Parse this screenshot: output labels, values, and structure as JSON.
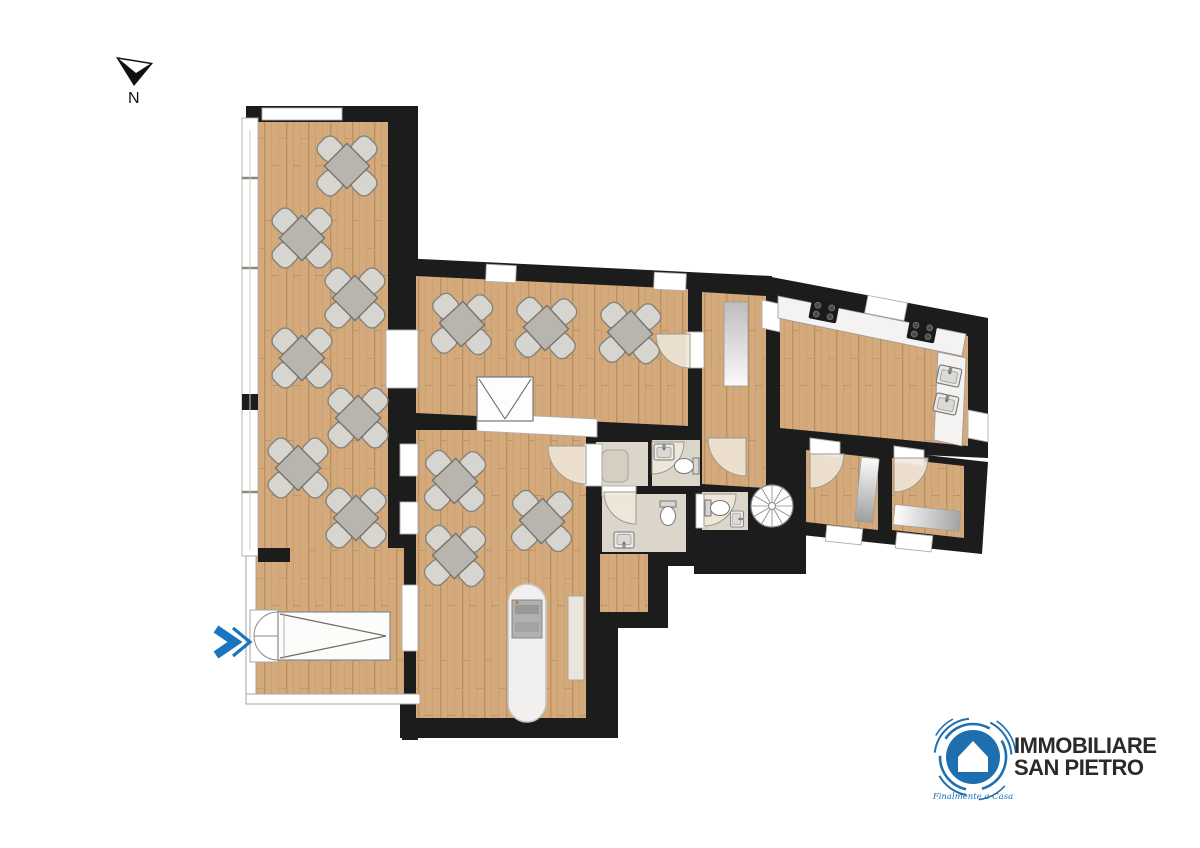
{
  "compass": {
    "label": "N"
  },
  "entrance_marker": {
    "color": "#1a74bf"
  },
  "logo": {
    "name_line1": "IMMOBILIARE",
    "name_line2": "SAN PIETRO",
    "tagline": "Finalmente a Casa",
    "brand_blue": "#1e6fb0",
    "text_color": "#2b2a29"
  },
  "floorplan": {
    "colors": {
      "wall": "#1c1c1c",
      "wood": "#d4aa7d",
      "bathroom_floor": "#dcd6ca",
      "window": "#ffffff",
      "door_swing": "#f0e9dc",
      "table": "#b7b5ae",
      "chair": "#d7d5cf"
    },
    "counts": {
      "dining_tables": 13,
      "toilets": 3,
      "bathroom_sinks": 3,
      "kitchen_sinks": 2,
      "cooktops": 2,
      "spiral_staircases": 1,
      "bar_counters": 1
    }
  }
}
